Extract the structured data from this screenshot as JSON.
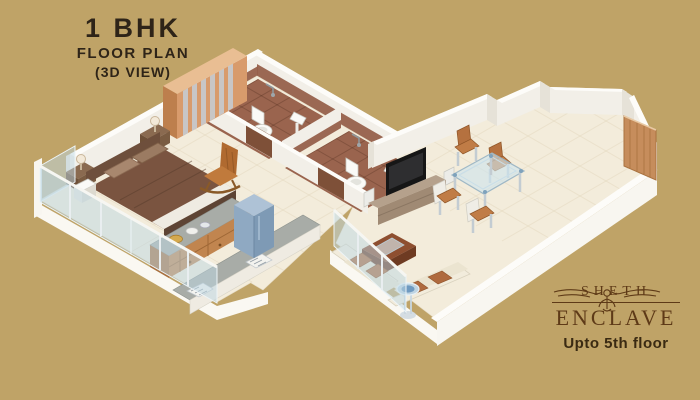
{
  "header": {
    "line1": "1 BHK",
    "line2": "FLOOR PLAN",
    "line3": "(3D VIEW)"
  },
  "brand": {
    "name": "SHETH",
    "project": "ENCLAVE",
    "tagline": "Upto 5th floor"
  },
  "colors": {
    "background": "#BFA367",
    "title_text": "#2E2418",
    "brand_text": "#5E3A17",
    "tagline_text": "#3A2A12",
    "floor_cream": "#F3ECDB",
    "wall_white": "#F2EFE8",
    "bath_tile_brown": "#9A644E",
    "wood": "#C1854F",
    "fridge_blue": "#8FA9C2",
    "sofa_cream": "#EFE8D6",
    "cushion_rust": "#AF6A3E",
    "glass_blue": "rgba(190,215,228,0.5)"
  },
  "floor_plan": {
    "type": "3d-isometric",
    "unit": "1 BHK apartment",
    "rooms": [
      {
        "name": "bedroom",
        "furniture": [
          "double-bed",
          "pillows",
          "nightstand-with-lamp",
          "nightstand-with-lamp",
          "wardrobe-with-glass-slats",
          "rocking-chair"
        ]
      },
      {
        "name": "balcony-bedroom",
        "furniture": [
          "glass-railing",
          "storage-box"
        ]
      },
      {
        "name": "kitchen",
        "furniture": [
          "granite-counter-with-drawers",
          "cooking-platform",
          "sink",
          "gas-stove",
          "refrigerator",
          "crockery"
        ]
      },
      {
        "name": "bathroom-1",
        "furniture": [
          "toilet",
          "washbasin",
          "shower"
        ]
      },
      {
        "name": "bathroom-2",
        "furniture": [
          "toilet",
          "washbasin",
          "shower"
        ]
      },
      {
        "name": "living-dining",
        "furniture": [
          "tv-unit",
          "television",
          "speakers",
          "glass-dining-table",
          "dining-chair",
          "dining-chair",
          "dining-chair",
          "dining-chair",
          "l-shaped-sofa",
          "coffee-table",
          "round-glass-side-table",
          "entrance-door"
        ]
      },
      {
        "name": "balcony-living",
        "furniture": [
          "glass-railing"
        ]
      }
    ]
  }
}
